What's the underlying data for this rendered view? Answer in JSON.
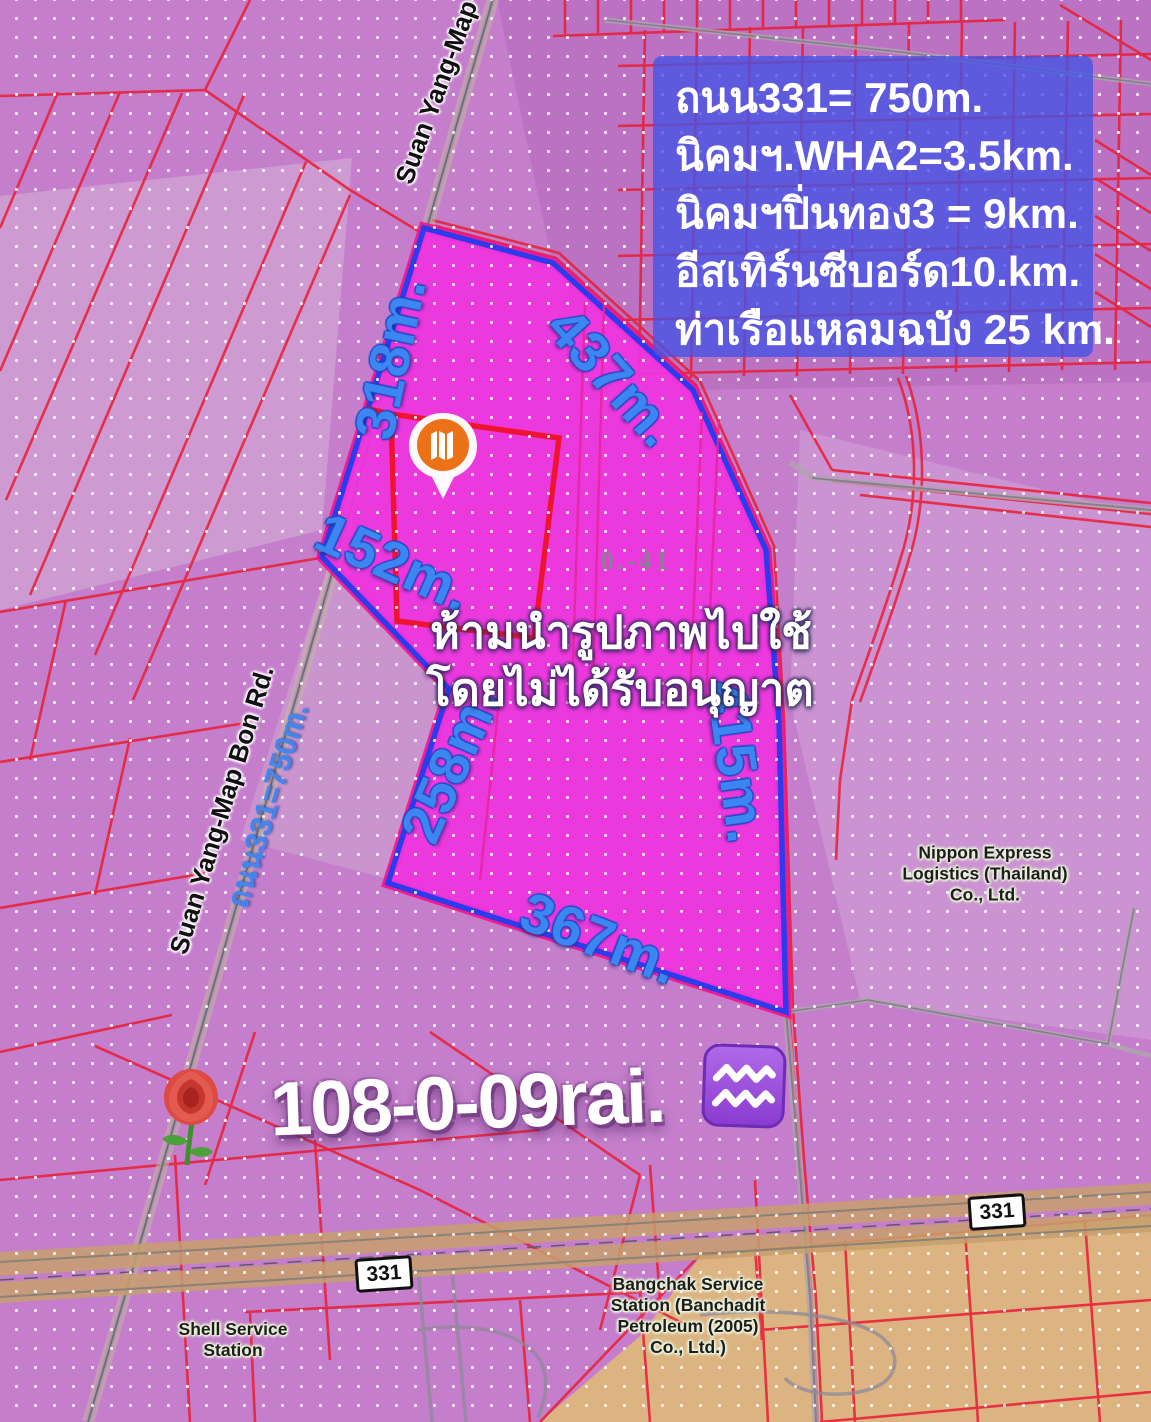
{
  "info_box": {
    "lines": [
      "ถนน331= 750m.",
      "นิคมฯ.WHA2=3.5km.",
      "นิคมฯปิ่นทอง3 = 9km.",
      "อีสเทิร์นซีบอร์ด10.km.",
      "ท่าเรือแหลมฉบัง 25 km."
    ],
    "bg_color": "#4453e6"
  },
  "parcel": {
    "side_labels": [
      "318m.",
      "437m.",
      "152m.",
      "258m.",
      "415m.",
      "367m."
    ],
    "code_label": "0.-41",
    "fill_color": "#ef33df",
    "outline_color": "#2c3cec"
  },
  "watermark": {
    "line1": "ห้ามนำรูปภาพไปใช้",
    "line2": "โดยไม่ได้รับอนุญาต"
  },
  "title": {
    "area_text": "108-0-09rai.",
    "left_icon": "rose-emoji",
    "right_icon": "aquarius-emoji"
  },
  "roads": {
    "suan_yang_label": "Suan Yang-Map Bon Rd.",
    "suan_yang_label_top": "Suan Yang-Map Bon Rd.",
    "thanon331_label": "ถนน331=750m.",
    "route_badge_left": "331",
    "route_badge_right": "331"
  },
  "places": {
    "nippon": [
      "Nippon Express",
      "Logistics (Thailand)",
      "Co., Ltd."
    ],
    "shell": [
      "Shell Service",
      "Station"
    ],
    "bangchak": [
      "Bangchak Service",
      "Station (Banchadit",
      "Petroleum (2005)",
      "Co., Ltd.)"
    ]
  },
  "colors": {
    "background_purple": "#c47ecb",
    "cadastral_red": "#e82138",
    "road_gray": "#a79aa5",
    "tan_zone": "#ddb97c",
    "measurement_blue": "#3b86f0",
    "pin_orange": "#ed7117"
  }
}
